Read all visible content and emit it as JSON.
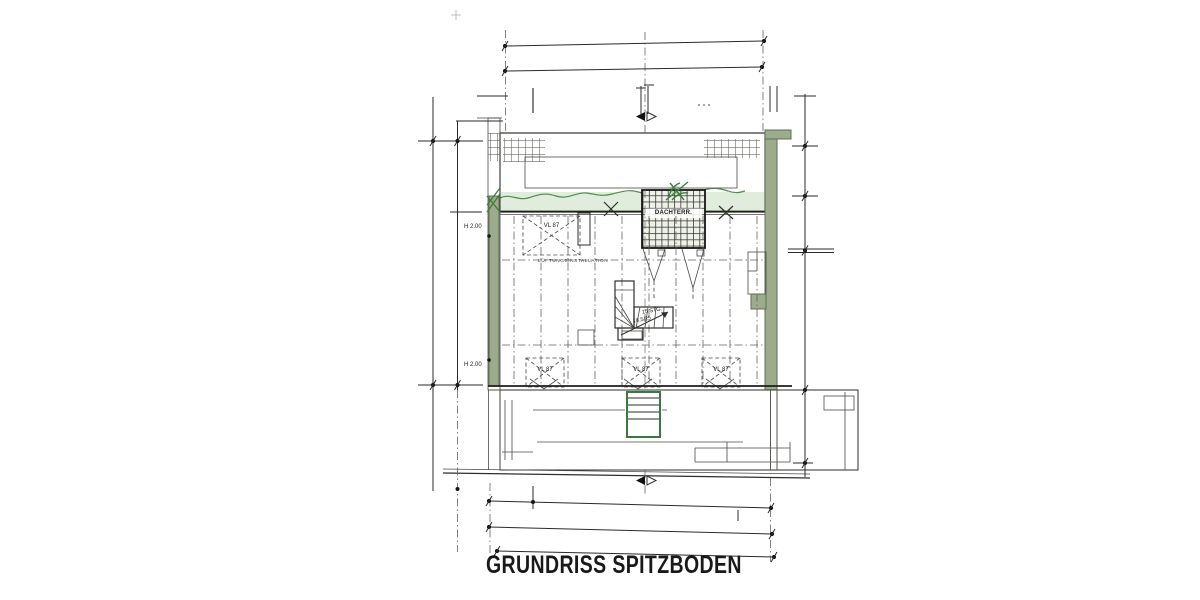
{
  "title": "GRUNDRISS SPITZBODEN",
  "plan": {
    "terrace_label": "DACHTERR.",
    "roof_windows": [
      "VL 87",
      "VL 87",
      "VL 87",
      "VL 87"
    ],
    "height_marks": [
      "H 2.00",
      "H 2.00"
    ],
    "stairs": {
      "line1": "15 STG.",
      "line2": "18,5/25"
    },
    "duct_label": "LÜFTUNGSINSTALLATION"
  },
  "colors": {
    "paper": "#ffffff",
    "ink": "#2e2e2c",
    "hatch": "#8d8577",
    "wall_green": "#9cab8c",
    "wall_green_dark": "#5f6d55",
    "accent_green": "#3f7d3c"
  }
}
